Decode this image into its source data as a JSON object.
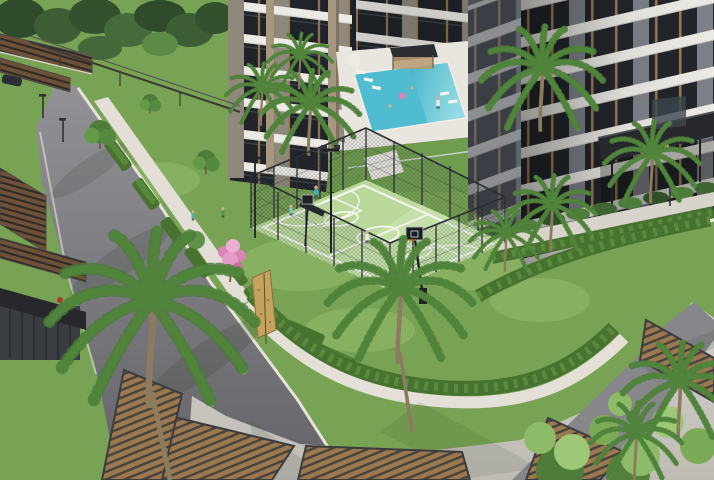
{
  "meta": {
    "width": 714,
    "height": 480,
    "alt": "Aerial 3D architectural rendering of a residential complex courtyard with apartment towers, swimming pool, fenced basketball court, palm trees, hedges, walkways, roads, carports and wooden deck terraces"
  },
  "colors": {
    "lawn": "#79a354",
    "lawn_light": "#94bd6c",
    "lawn_dark": "#5d8a43",
    "hedge": "#47722f",
    "hedge_light": "#6aa047",
    "palm": "#6fa84f",
    "palm_dark": "#4a7c37",
    "trunk": "#8d7b5f",
    "court": "#bad89b",
    "court_line": "#f7f7f2",
    "fence": "#2c3034",
    "road": "#87878b",
    "road_dark": "#6e6e72",
    "curb": "#e6e2da",
    "plaza": "#cbc8c1",
    "path_white": "#e3dfd7",
    "deck_wood": "#9c7850",
    "deck_frame": "#3c3c3e",
    "bldg_tan": "#a5987f",
    "bldg_wall": "#8e897b",
    "bldg_gray": "#7d8088",
    "bldg_gray_dark": "#4e5158",
    "slab_white": "#eceae5",
    "glass": "#22262b",
    "frame_tan": "#9b7e57",
    "pool": "#4fbccf",
    "pool_light": "#a5e0e8",
    "pool_deck": "#e9e6e0",
    "pink": "#d984b8",
    "pink_light": "#edaed3",
    "trees_dark": "#36522f",
    "canopy": "#26282c",
    "sign_gold": "#c9a566",
    "skin": "#d8ae89"
  },
  "objects": {
    "buildings": [
      "left residential tower",
      "rear tower behind pool",
      "right residential tower with entrance canopy"
    ],
    "amenities": [
      "swimming pool with cabana and loungers",
      "fenced basketball court with two hoops and floodlights",
      "climbing board",
      "carport pergolas",
      "wooden deck terraces",
      "street kiosk structure"
    ],
    "landscape": [
      "palm trees",
      "box hedges",
      "lawns",
      "pink blossom tree",
      "dark background trees",
      "foreground shrubs"
    ],
    "court": {
      "surface": "light green",
      "lines": "white",
      "hoops": 2,
      "floodlights": 2,
      "bench": 1
    },
    "pool": {
      "water": "turquoise",
      "float_color": "pink",
      "cabanas": 1,
      "umbrellas": 1
    },
    "people_shirt_colors": [
      "#35b3c6",
      "#c23b31",
      "#e8e8e8",
      "#4f9b44",
      "#7fc8c0",
      "#4fb0a6"
    ]
  }
}
